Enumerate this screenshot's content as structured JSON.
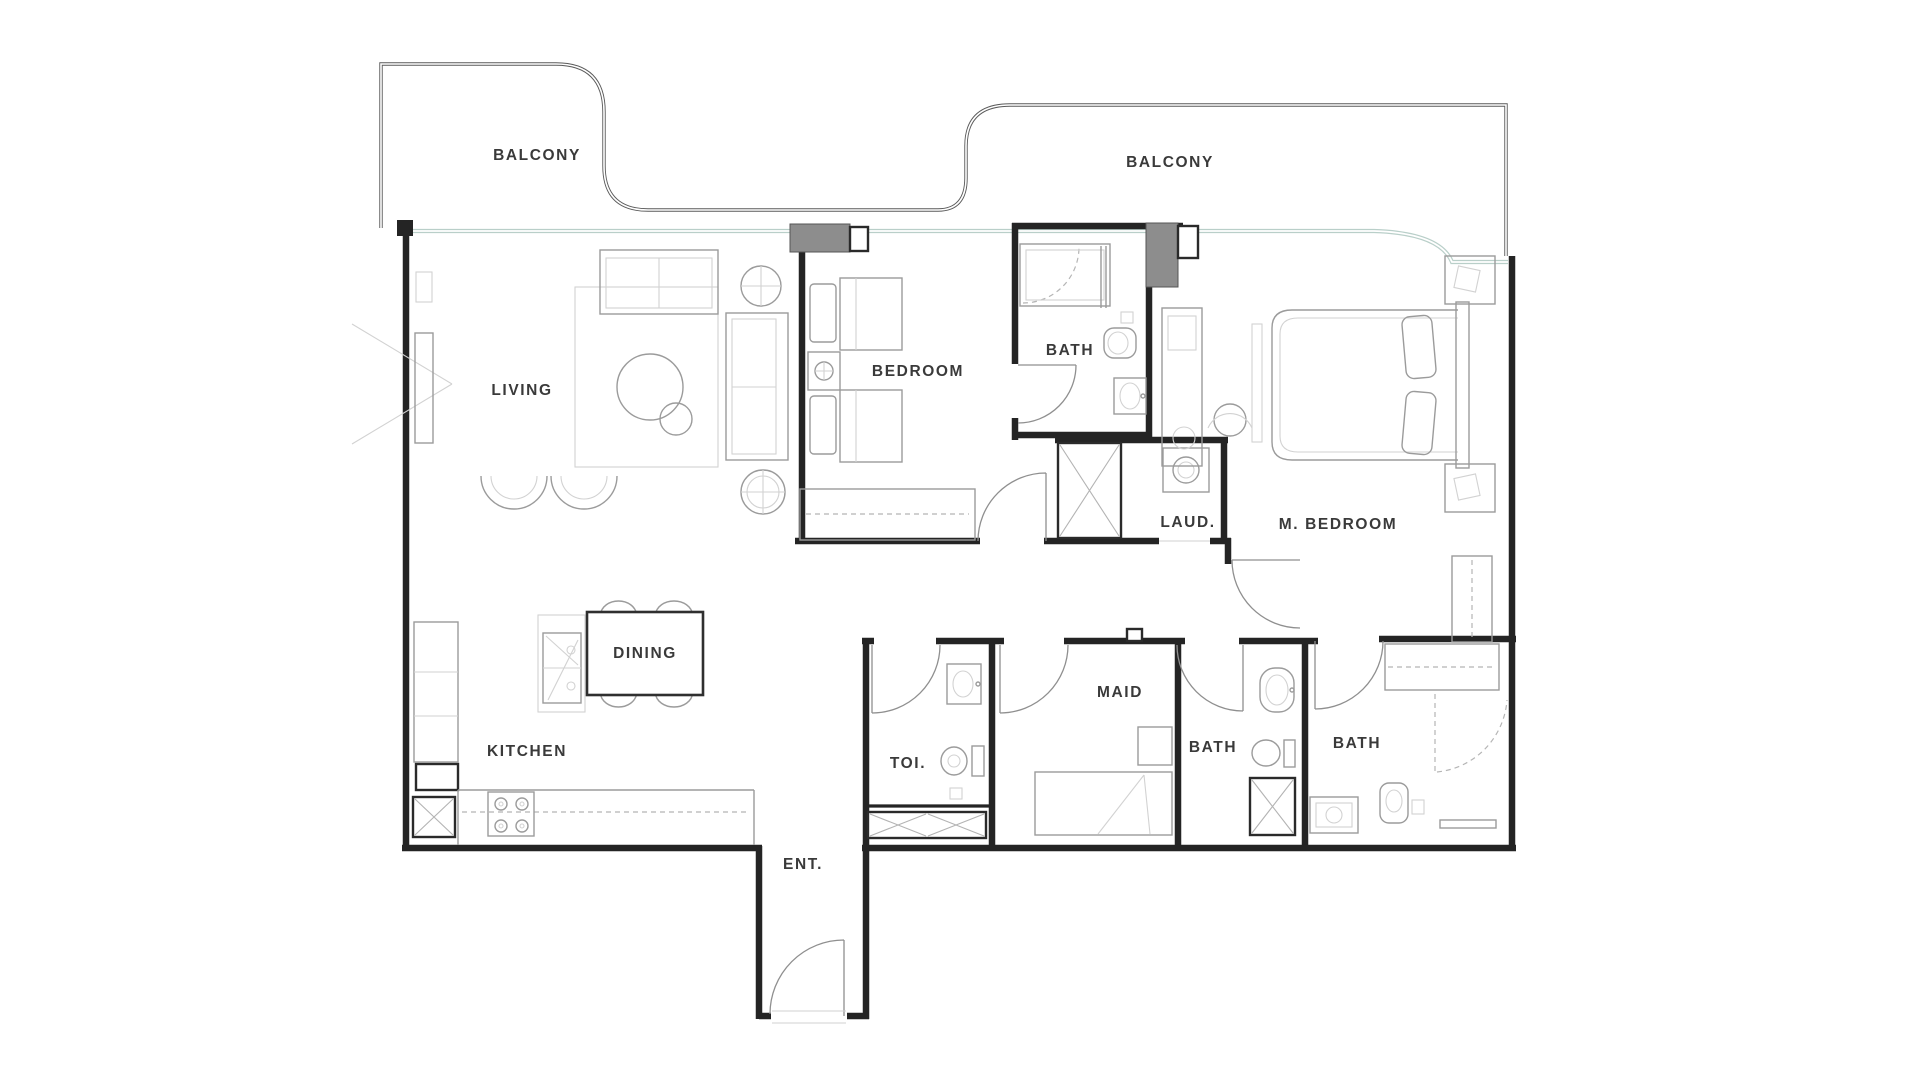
{
  "plan": {
    "labels": {
      "balcony_left": "BALCONY",
      "balcony_right": "BALCONY",
      "living": "LIVING",
      "bedroom": "BEDROOM",
      "bath": "BATH",
      "laundry": "LAUD.",
      "master_bedroom": "M. BEDROOM",
      "dining": "DINING",
      "kitchen": "KITCHEN",
      "toilet": "TOI.",
      "maid": "MAID",
      "bath_maid": "BATH",
      "bath_master": "BATH",
      "entrance": "ENT."
    },
    "colors": {
      "wall": "#242424",
      "furn": "#9b9b9b",
      "glaze": "#b9cfc9",
      "column": "#8d8d8d",
      "label": "#3a3a3a",
      "door": "#8f8f8f",
      "bg": "#ffffff"
    }
  }
}
